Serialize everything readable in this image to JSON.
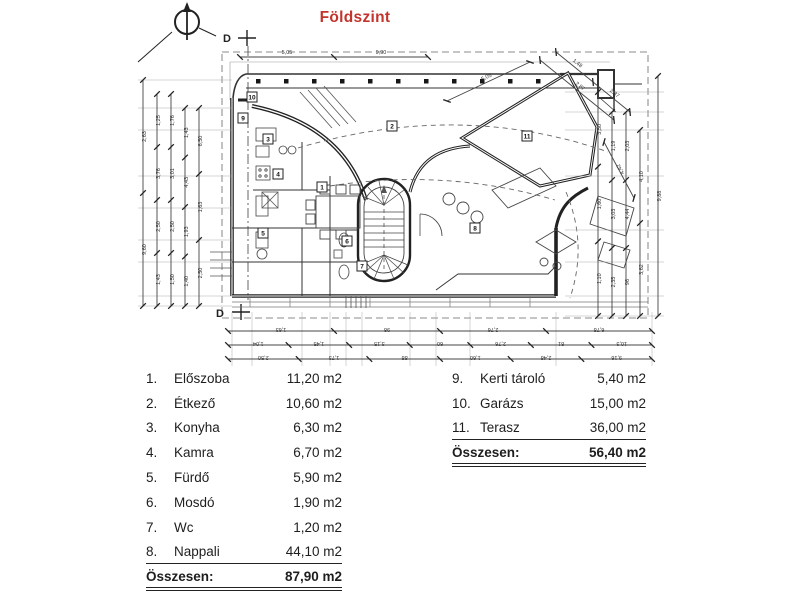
{
  "title": "Földszint",
  "title_color": "#c2342c",
  "plan": {
    "section_marker": "D",
    "room_markers": [
      {
        "num": "1",
        "x": 322,
        "y": 187
      },
      {
        "num": "2",
        "x": 392,
        "y": 126
      },
      {
        "num": "3",
        "x": 268,
        "y": 139
      },
      {
        "num": "4",
        "x": 278,
        "y": 174
      },
      {
        "num": "5",
        "x": 263,
        "y": 233
      },
      {
        "num": "6",
        "x": 347,
        "y": 241
      },
      {
        "num": "7",
        "x": 362,
        "y": 266
      },
      {
        "num": "8",
        "x": 475,
        "y": 228
      },
      {
        "num": "9",
        "x": 243,
        "y": 118
      },
      {
        "num": "10",
        "x": 252,
        "y": 97
      },
      {
        "num": "11",
        "x": 527,
        "y": 136
      }
    ],
    "dim_chains": [
      {
        "x1": 143,
        "y1": 80,
        "x2": 143,
        "y2": 306,
        "labels": [
          "2,63",
          "9,60"
        ]
      },
      {
        "x1": 157,
        "y1": 94,
        "x2": 157,
        "y2": 306,
        "labels": [
          "1,25",
          "3,76",
          "2,50",
          "1,43"
        ]
      },
      {
        "x1": 171,
        "y1": 94,
        "x2": 171,
        "y2": 306,
        "labels": [
          "1,76",
          "3,01",
          "2,50",
          "1,50"
        ]
      },
      {
        "x1": 185,
        "y1": 108,
        "x2": 185,
        "y2": 306,
        "labels": [
          "1,43",
          "4,43",
          "1,93",
          "1,40"
        ]
      },
      {
        "x1": 199,
        "y1": 108,
        "x2": 199,
        "y2": 306,
        "labels": [
          "6,50",
          "1,63",
          "2,50"
        ]
      },
      {
        "x1": 598,
        "y1": 92,
        "x2": 598,
        "y2": 316,
        "labels": [
          "3,50",
          "1,60",
          "1,10"
        ]
      },
      {
        "x1": 612,
        "y1": 112,
        "x2": 612,
        "y2": 316,
        "labels": [
          "1,19",
          "3,03",
          "2,35"
        ]
      },
      {
        "x1": 626,
        "y1": 112,
        "x2": 626,
        "y2": 316,
        "labels": [
          "2,03",
          "4,44",
          "96"
        ]
      },
      {
        "x1": 640,
        "y1": 130,
        "x2": 640,
        "y2": 316,
        "labels": [
          "4,10",
          "3,62"
        ]
      },
      {
        "x1": 658,
        "y1": 76,
        "x2": 658,
        "y2": 316,
        "labels": [
          "9,88"
        ]
      },
      {
        "x1": 240,
        "y1": 57,
        "x2": 428,
        "y2": 57,
        "labels": [
          "5,05",
          "9,90"
        ]
      },
      {
        "x1": 228,
        "y1": 331,
        "x2": 652,
        "y2": 331,
        "labels": [
          "1,63",
          "98",
          "2,76",
          "6,78"
        ],
        "flip": true
      },
      {
        "x1": 228,
        "y1": 345,
        "x2": 652,
        "y2": 345,
        "labels": [
          "1,04",
          "1,45",
          "3,15",
          "60",
          "2,76",
          "81",
          "10,3"
        ],
        "flip": true
      },
      {
        "x1": 228,
        "y1": 359,
        "x2": 652,
        "y2": 359,
        "labels": [
          "2,50",
          "1,73",
          "88",
          "1,60",
          "2,48",
          "9,16"
        ],
        "flip": true
      },
      {
        "x1": 447,
        "y1": 101,
        "x2": 530,
        "y2": 62,
        "labels": [
          "5,05"
        ]
      },
      {
        "x1": 540,
        "y1": 60,
        "x2": 614,
        "y2": 120,
        "labels": [
          "2,87"
        ]
      },
      {
        "x1": 556,
        "y1": 52,
        "x2": 630,
        "y2": 112,
        "labels": [
          "1,48",
          "2,87"
        ]
      },
      {
        "x1": 604,
        "y1": 142,
        "x2": 634,
        "y2": 198,
        "labels": [
          "4,42"
        ]
      }
    ]
  },
  "legend": {
    "left": {
      "rows": [
        {
          "num": "1.",
          "name": "Előszoba",
          "area": "11,20 m2"
        },
        {
          "num": "2.",
          "name": "Étkező",
          "area": "10,60 m2"
        },
        {
          "num": "3.",
          "name": "Konyha",
          "area": "6,30 m2"
        },
        {
          "num": "4.",
          "name": "Kamra",
          "area": "6,70 m2"
        },
        {
          "num": "5.",
          "name": "Fürdő",
          "area": "5,90 m2"
        },
        {
          "num": "6.",
          "name": "Mosdó",
          "area": "1,90 m2"
        },
        {
          "num": "7.",
          "name": "Wc",
          "area": "1,20 m2"
        },
        {
          "num": "8.",
          "name": "Nappali",
          "area": "44,10 m2",
          "underline": true
        }
      ],
      "total_label": "Összesen:",
      "total_value": "87,90 m2"
    },
    "right": {
      "rows": [
        {
          "num": "9.",
          "name": "Kerti tároló",
          "area": "5,40 m2"
        },
        {
          "num": "10.",
          "name": "Garázs",
          "area": "15,00 m2"
        },
        {
          "num": "11.",
          "name": "Terasz",
          "area": "36,00 m2",
          "underline": true
        }
      ],
      "total_label": "Összesen:",
      "total_value": "56,40 m2"
    }
  }
}
